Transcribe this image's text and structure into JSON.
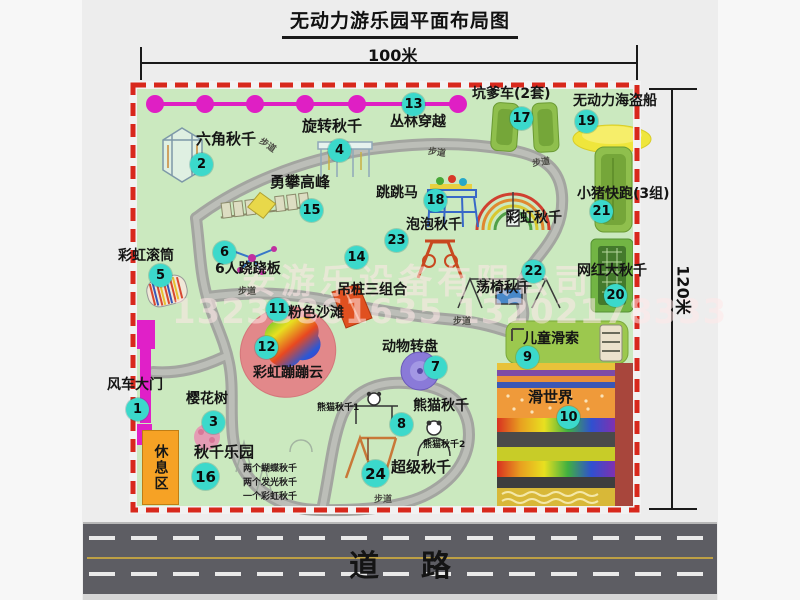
{
  "title": "无动力游乐园平面布局图",
  "dimensions": {
    "horizontal": "100米",
    "vertical": "120米"
  },
  "watermark": {
    "company": "安游乐设备有限公司",
    "phone": "13233861635 13202178333"
  },
  "road_label": "道    路",
  "rest_area_label": "休息区",
  "path_label": "步道",
  "rainbow_swing_label": "彩虹秋千",
  "panda1_label": "熊猫秋千1",
  "panda2_label": "熊猫秋千2",
  "swing_park_sublabels": [
    "两个蝴蝶秋千",
    "两个发光秋千",
    "一个彩虹秋千"
  ],
  "attractions": [
    {
      "num": "1",
      "label": "风车大门"
    },
    {
      "num": "2",
      "label": "六角秋千"
    },
    {
      "num": "3",
      "label": "樱花树"
    },
    {
      "num": "4",
      "label": "旋转秋千"
    },
    {
      "num": "5",
      "label": "彩虹滚筒"
    },
    {
      "num": "6",
      "label": "6人跷跷板"
    },
    {
      "num": "7",
      "label": "动物转盘"
    },
    {
      "num": "8",
      "label": "熊猫秋千"
    },
    {
      "num": "9",
      "label": "儿童滑索"
    },
    {
      "num": "10",
      "label": "滑世界"
    },
    {
      "num": "11",
      "label": "粉色沙滩"
    },
    {
      "num": "12",
      "label": "彩虹蹦蹦云"
    },
    {
      "num": "13",
      "label": "丛林穿越"
    },
    {
      "num": "14",
      "label": "吊桩三组合"
    },
    {
      "num": "15",
      "label": "勇攀高峰"
    },
    {
      "num": "16",
      "label": "秋千乐园"
    },
    {
      "num": "17",
      "label": "坑爹车(2套)"
    },
    {
      "num": "18",
      "label": "跳跳马"
    },
    {
      "num": "19",
      "label": "无动力海盗船"
    },
    {
      "num": "20",
      "label": "网红大秋千"
    },
    {
      "num": "21",
      "label": "小猪快跑(3组)"
    },
    {
      "num": "22",
      "label": "荡椅秋千"
    },
    {
      "num": "23",
      "label": "泡泡秋千"
    },
    {
      "num": "24",
      "label": "超级秋千"
    }
  ],
  "map_colors": {
    "ground": "#cbe9bf",
    "border": "#d8281c",
    "badge": "#3bd9cb",
    "chain": "#df1fc4"
  }
}
